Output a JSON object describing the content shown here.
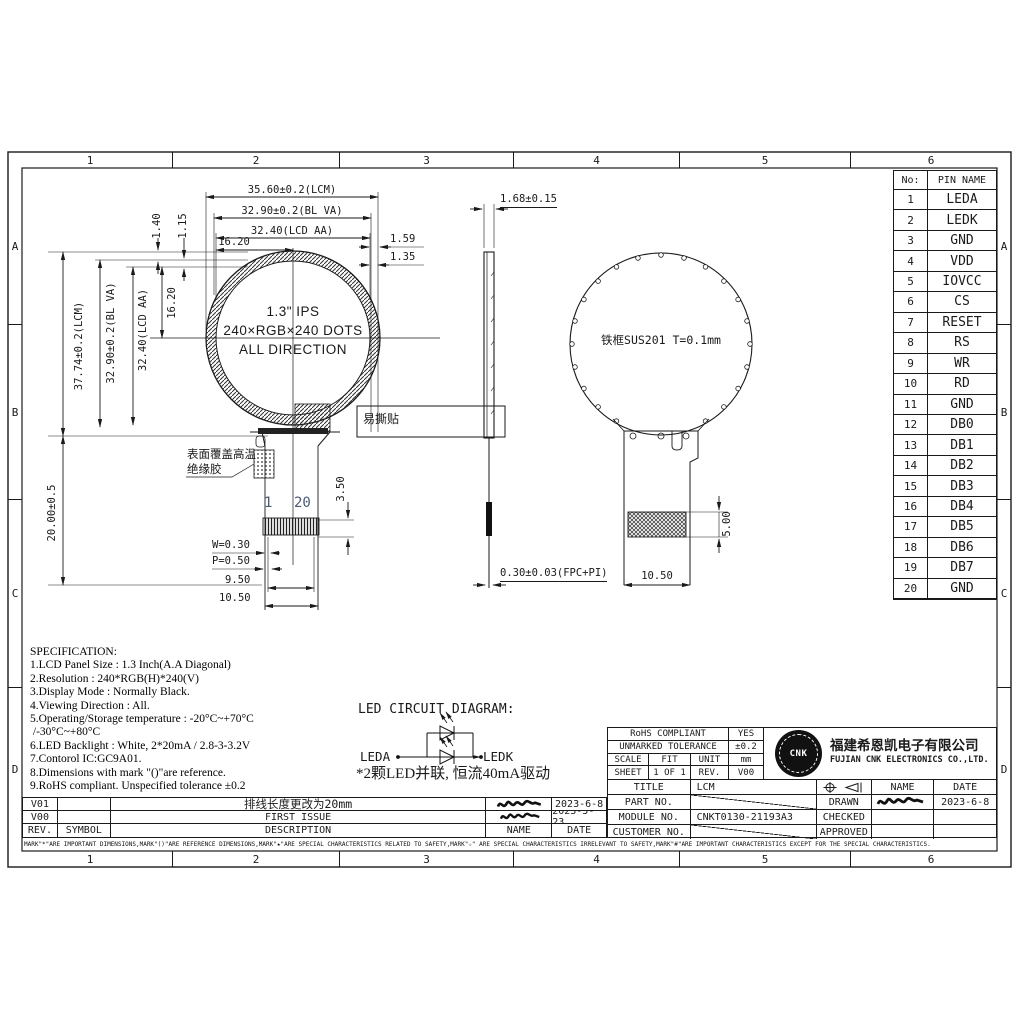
{
  "colors": {
    "line": "#1a1a1a",
    "background": "#ffffff",
    "pin_number_accent": "#4a5a78"
  },
  "frame": {
    "cols": [
      "1",
      "2",
      "3",
      "4",
      "5",
      "6"
    ],
    "rows": [
      "A",
      "B",
      "C",
      "D"
    ]
  },
  "front_view": {
    "display_line1": "1.3\" IPS",
    "display_line2": "240×RGB×240 DOTS",
    "display_line3": "ALL DIRECTION",
    "dim_width_lcm": "35.60±0.2(LCM)",
    "dim_width_blva": "32.90±0.2(BL VA)",
    "dim_width_lcdaa": "32.40(LCD AA)",
    "dim_width_half": "16.20",
    "dim_right_1": "1.59",
    "dim_right_2": "1.35",
    "dim_height_lcm": "37.74±0.2(LCM)",
    "dim_height_blva": "32.90±0.2(BL VA)",
    "dim_height_lcdaa": "32.40(LCD AA)",
    "dim_height_half": "16.20",
    "dim_top_1": "1.40",
    "dim_top_2": "1.15",
    "dim_tail_length": "20.00±0.5",
    "dim_connector_offset": "3.50",
    "easy_tear_label": "易撕贴",
    "glue_label_line1": "表面覆盖高温",
    "glue_label_line2": "绝缘胶",
    "pin_first": "1",
    "pin_last": "20",
    "dim_pin_width": "W=0.30",
    "dim_pin_pitch": "P=0.50",
    "dim_pins_span": "9.50",
    "dim_fpc_width": "10.50"
  },
  "side_view": {
    "dim_thickness": "1.68±0.15",
    "dim_fpc_thickness": "0.30±0.03(FPC+PI)"
  },
  "back_view": {
    "frame_label": "铁框SUS201 T=0.1mm",
    "dim_stiffener_height": "5.00",
    "dim_tail_width": "10.50"
  },
  "pin_table": {
    "header_no": "No:",
    "header_name": "PIN NAME",
    "rows": [
      {
        "no": "1",
        "name": "LEDA"
      },
      {
        "no": "2",
        "name": "LEDK"
      },
      {
        "no": "3",
        "name": "GND"
      },
      {
        "no": "4",
        "name": "VDD"
      },
      {
        "no": "5",
        "name": "IOVCC"
      },
      {
        "no": "6",
        "name": "CS"
      },
      {
        "no": "7",
        "name": "RESET"
      },
      {
        "no": "8",
        "name": "RS"
      },
      {
        "no": "9",
        "name": "WR"
      },
      {
        "no": "10",
        "name": "RD"
      },
      {
        "no": "11",
        "name": "GND"
      },
      {
        "no": "12",
        "name": "DB0"
      },
      {
        "no": "13",
        "name": "DB1"
      },
      {
        "no": "14",
        "name": "DB2"
      },
      {
        "no": "15",
        "name": "DB3"
      },
      {
        "no": "16",
        "name": "DB4"
      },
      {
        "no": "17",
        "name": "DB5"
      },
      {
        "no": "18",
        "name": "DB6"
      },
      {
        "no": "19",
        "name": "DB7"
      },
      {
        "no": "20",
        "name": "GND"
      }
    ]
  },
  "specification": {
    "lines": [
      "SPECIFICATION:",
      "1.LCD Panel Size : 1.3 Inch(A.A Diagonal)",
      "2.Resolution : 240*RGB(H)*240(V)",
      "3.Display Mode : Normally Black.",
      "4.Viewing Direction : All.",
      "5.Operating/Storage temperature : -20°C~+70°C",
      " /-30°C~+80°C",
      "6.LED Backlight : White, 2*20mA / 2.8-3-3.2V",
      "7.Contorol IC:GC9A01.",
      "8.Dimensions with mark \"()\"are reference.",
      "9.RoHS compliant. Unspecified tolerance ±0.2"
    ]
  },
  "led_circuit": {
    "title": "LED CIRCUIT DIAGRAM:",
    "anode_label": "LEDA",
    "cathode_label": "LEDK",
    "note": "*2颗LED并联, 恒流40mA驱动"
  },
  "revision_table": {
    "header": {
      "rev": "REV.",
      "symbol": "SYMBOL",
      "description": "DESCRIPTION",
      "name": "NAME",
      "date": "DATE"
    },
    "rows": [
      {
        "rev": "V01",
        "symbol": "",
        "description": "排线长度更改为20mm",
        "date": "2023-6-8"
      },
      {
        "rev": "V00",
        "symbol": "",
        "description": "FIRST ISSUE",
        "date": "2023-5-23"
      }
    ]
  },
  "title_block": {
    "rohs_label": "RoHS COMPLIANT",
    "rohs_value": "YES",
    "tolerance_label": "UNMARKED TOLERANCE",
    "tolerance_value": "±0.2",
    "scale_label": "SCALE",
    "scale_value": "FIT",
    "unit_label": "UNIT",
    "unit_value": "mm",
    "sheet_label": "SHEET",
    "sheet_value": "1 OF 1",
    "rev_label": "REV.",
    "rev_value": "V00",
    "company_cn": "福建希恩凯电子有限公司",
    "company_en": "FUJIAN CNK ELECTRONICS CO.,LTD.",
    "logo_text": "CNK",
    "title_label": "TITLE",
    "title_value": "LCM",
    "part_label": "PART NO.",
    "module_label": "MODULE NO.",
    "module_value": "CNKT0130-21193A3",
    "customer_label": "CUSTOMER NO.",
    "drawn_label": "DRAWN",
    "checked_label": "CHECKED",
    "approved_label": "APPROVED",
    "name_label": "NAME",
    "date_label": "DATE",
    "drawn_date": "2023-6-8"
  },
  "footer_note": "MARK\"*\"ARE IMPORTANT DIMENSIONS,MARK\"()\"ARE REFERENCE DIMENSIONS,MARK\"★\"ARE SPECIAL CHARACTERISTICS RELATED TO SAFETY,MARK\"☆\" ARE SPECIAL CHARACTERISTICS IRRELEVANT TO SAFETY,MARK\"#\"ARE IMPORTANT CHARACTERISTICS EXCEPT FOR THE SPECIAL CHARACTERISTICS."
}
